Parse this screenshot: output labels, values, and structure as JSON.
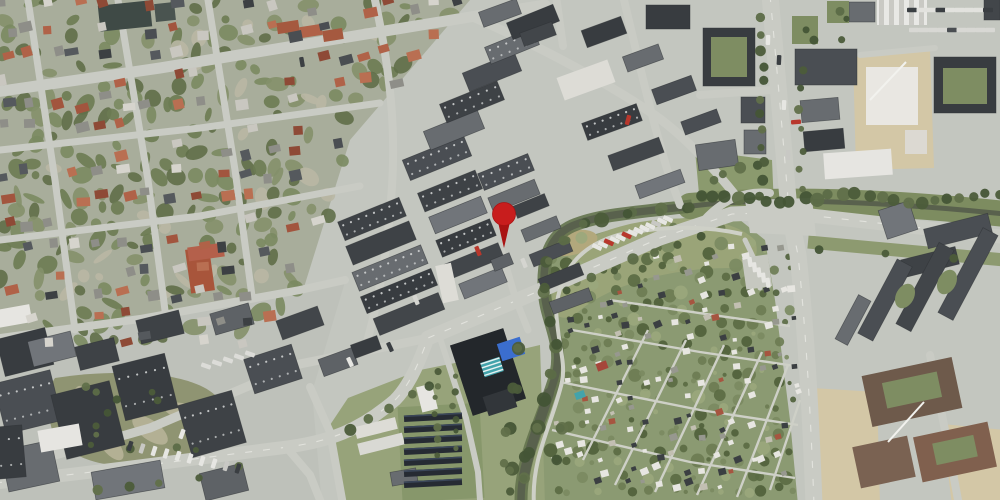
{
  "map": {
    "type": "aerial-satellite-photo",
    "description": "Aerial orthophoto of a town district: residential blocks northwest, industrial estate in the centre, a stream looping around allotment gardens southeast, arterial roads and construction sites east",
    "marker": {
      "name": "location-marker",
      "x": 504,
      "y": 214,
      "head_color": "#c81d1d",
      "stem_color": "#a91313",
      "head_radius": 11.5,
      "stem_length": 34
    },
    "palette": {
      "pavement": "#c3c6bf",
      "road": "#c9cbc4",
      "path": "#ced0c7",
      "residential_base": "#a8ad9b",
      "industrial_base": "#bec1ba",
      "vegetation": "#8b9a72",
      "meadow": "#9aa478",
      "field": "#97a37a",
      "reed": "#b2a87c",
      "water": "#59614d",
      "river_bank": "#64734e",
      "dark_roof": "#3e4246",
      "mid_roof": "#63676b",
      "white_roof": "#e7e6e1",
      "red_roof": "#a8553b",
      "brown_roof": "#6e5a4b",
      "construction_sand": "#d3c7a6",
      "solar_panel": "#262b33",
      "blue_panel": "#3b6ece",
      "teal_panel": "#43a3ab"
    }
  }
}
